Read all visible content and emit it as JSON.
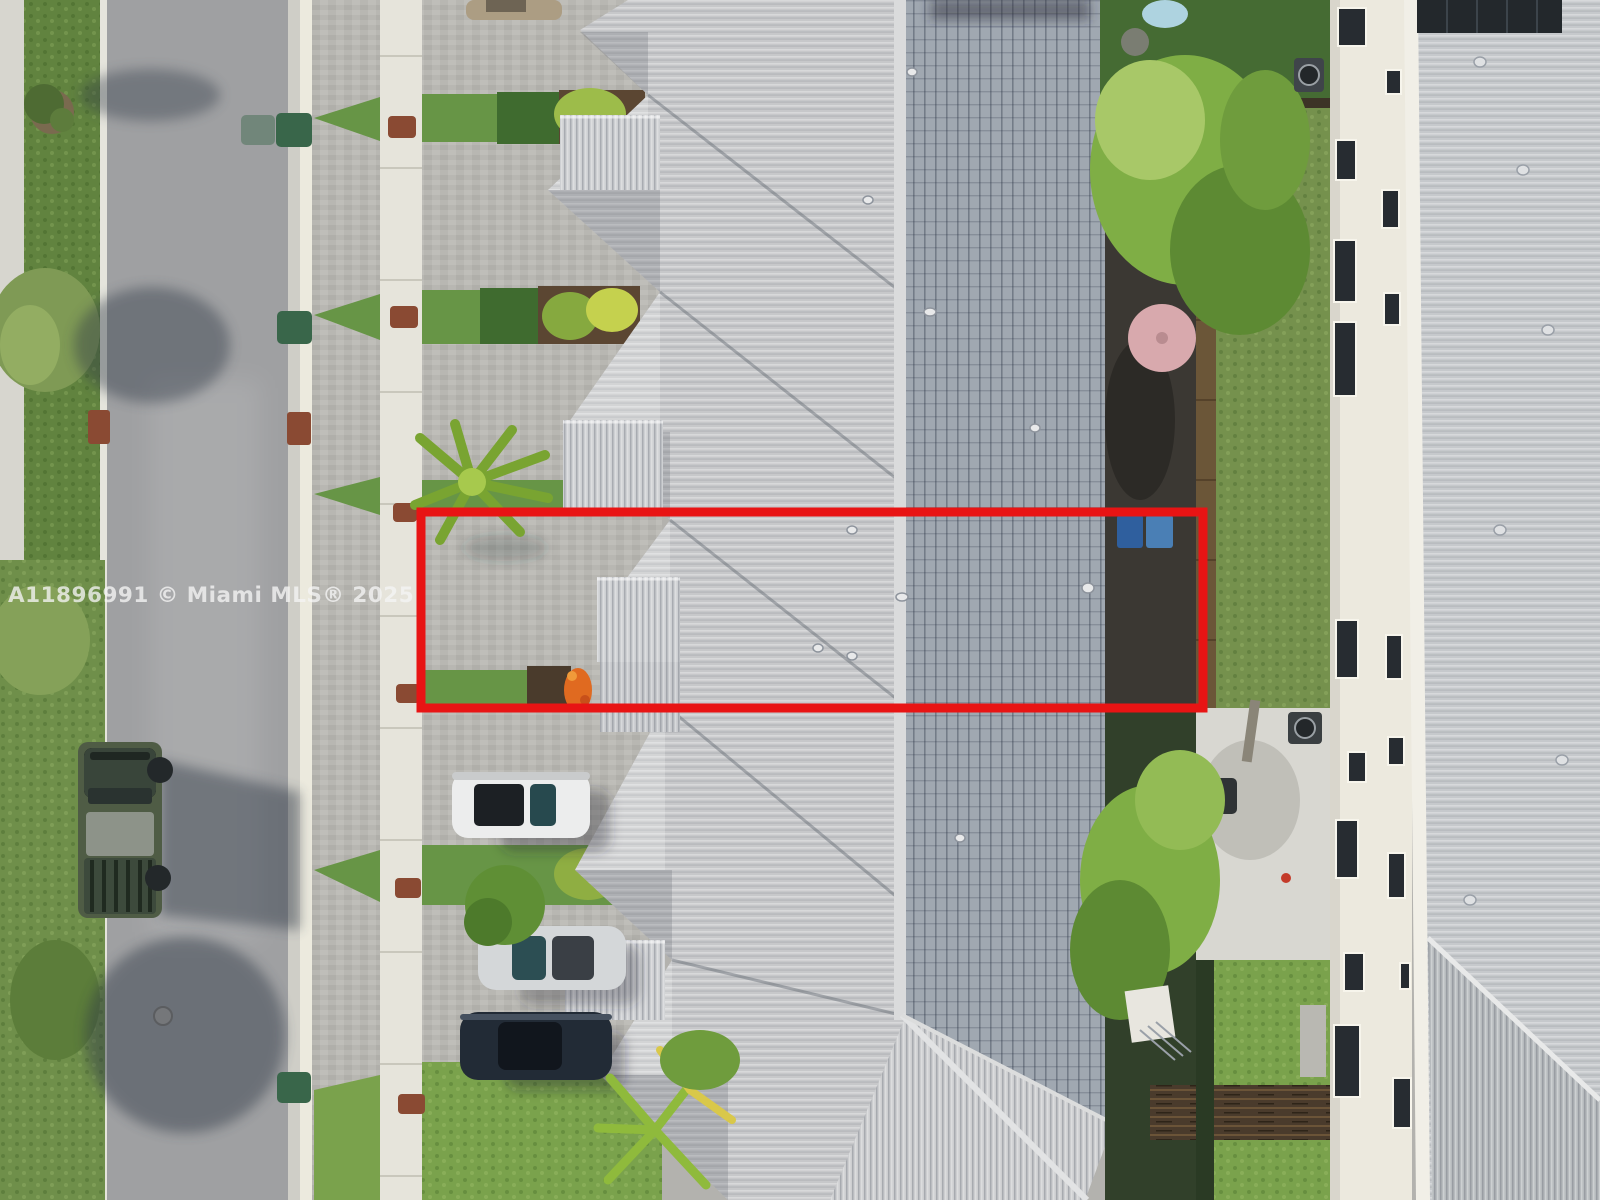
{
  "image": {
    "width": 1600,
    "height": 1200,
    "description": "Aerial drone view of a townhome community; one unit and its rear yard outlined with a red rectangle"
  },
  "watermark": {
    "text": "A11896991 © Miami MLS® 2025",
    "color": "#f5f5f5",
    "opacity": "0.78"
  },
  "highlight_box": {
    "x": "421",
    "y": "512",
    "width": "782",
    "height": "196",
    "stroke": "#e81414",
    "stroke_width": "9"
  },
  "palette": {
    "street": "#9fa0a2",
    "sidewalk": "#e6e4db",
    "paver": "#b8b7b2",
    "lawn_verge": "#61833f",
    "grass": "#679546",
    "grass_bright": "#7aa24c",
    "roof_main_light": "#c7c8ca",
    "roof_main_dark": "#9ba3ad",
    "roof_ridge": "#dadbdc",
    "roof_right": "#c6c9cc",
    "roof_right_lower": "#b7bbbe",
    "fascia": "#f1efe7",
    "wall_white": "#ece9de",
    "window_dark": "#272c31",
    "turf": "#456b33",
    "dirt_yard": "#3b3833",
    "weed_grass": "#75914d",
    "fence_wood": "#6b5638",
    "fence_dark": "#2a3a24",
    "patio": "#d8d7d1",
    "deck": "#4a3b2c",
    "truck_olive": "#4f5c45",
    "car_white": "#eceded",
    "car_silver": "#d4d7d9",
    "car_dark": "#222b36",
    "car_tan": "#ac9d83",
    "bin_green": "#39664a",
    "bins_blue": "#2f5f9e",
    "pool_blue": "#aed3e0",
    "umbrella_pink": "#d8a9ad",
    "solar_panel": "#23282c",
    "flowers_orange": "#e06a20",
    "palm_green": "#8fba3c",
    "tree_green": "#7fae45",
    "shadow": "#2e3744",
    "grate_brown": "#8a4a33"
  },
  "scene": {
    "vehicles": [
      {
        "name": "olive military-style truck",
        "where": "parked on street"
      },
      {
        "name": "white SUV",
        "where": "driveway"
      },
      {
        "name": "silver sedan",
        "where": "driveway"
      },
      {
        "name": "dark blue car",
        "where": "driveway"
      },
      {
        "name": "tan car (partial)",
        "where": "top driveway"
      }
    ],
    "trash_bin_count": 4,
    "visible_features": [
      "paver driveways",
      "white sidewalk",
      "gray tile roofs",
      "fenced backyards",
      "pink patio umbrella",
      "kiddie pool",
      "AC units",
      "rooftop solar panel",
      "palm trees"
    ]
  }
}
